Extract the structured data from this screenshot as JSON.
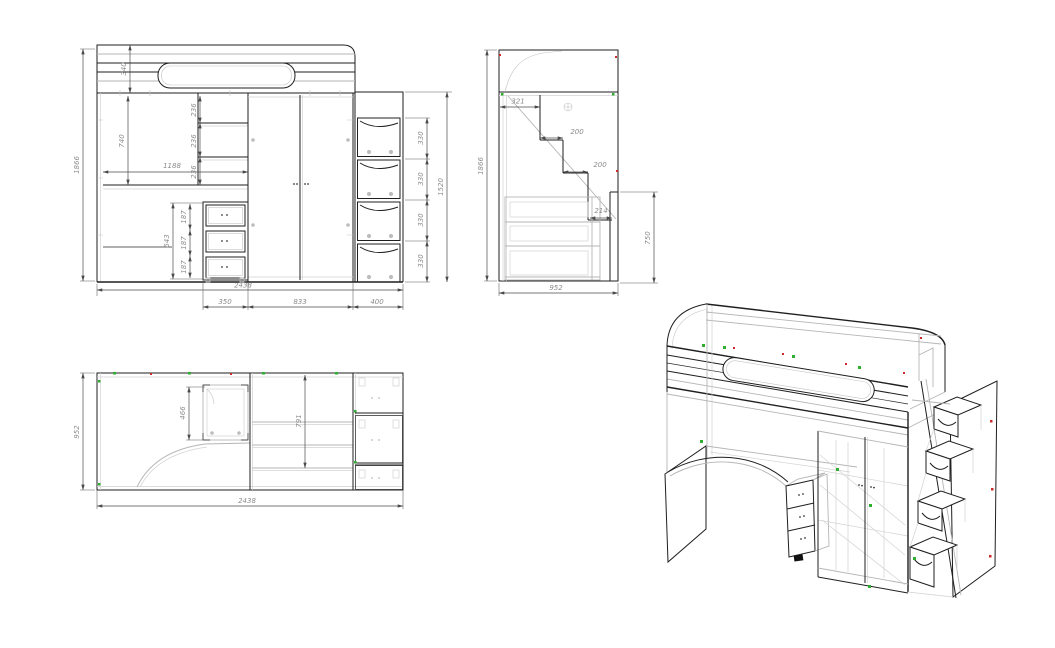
{
  "drawing": {
    "type": "furniture-technical-drawing",
    "subject": "loft-bed-with-desk-wardrobe-and-stair-drawers",
    "colors": {
      "line": "#1f1f1f",
      "secondary_line": "#b5b5b5",
      "dimension_text": "#8c8c8c",
      "marker_green": "#2fae2f",
      "marker_red": "#cc2a2a",
      "background": "#ffffff"
    }
  },
  "views": {
    "front": {
      "label": "front-orthographic-view",
      "dims": {
        "total_height": "1866",
        "headboard_height": "340",
        "underbed_height": "740",
        "desk_width": "1188",
        "shelf_gap_1": "236",
        "shelf_gap_2": "236",
        "shelf_gap_3": "236",
        "drawer_stack_height": "643",
        "drawer_1": "187",
        "drawer_2": "187",
        "drawer_3": "187",
        "total_width": "2438",
        "drawer_unit_width": "350",
        "wardrobe_width": "833",
        "ladder_width": "400",
        "ladder_height": "1520",
        "step_1": "330",
        "step_2": "330",
        "step_3": "330",
        "step_4": "330"
      }
    },
    "side": {
      "label": "side-orthographic-view",
      "dims": {
        "total_height": "1866",
        "top_step_depth": "321",
        "step_depth_2": "200",
        "step_depth_3": "200",
        "step_depth_4": "214",
        "lower_unit_height": "750",
        "total_depth": "952"
      }
    },
    "top": {
      "label": "top-orthographic-view",
      "dims": {
        "total_depth": "952",
        "total_width": "2438",
        "inner_depth": "466",
        "wardrobe_depth": "791"
      }
    },
    "iso": {
      "label": "isometric-3d-view"
    }
  }
}
